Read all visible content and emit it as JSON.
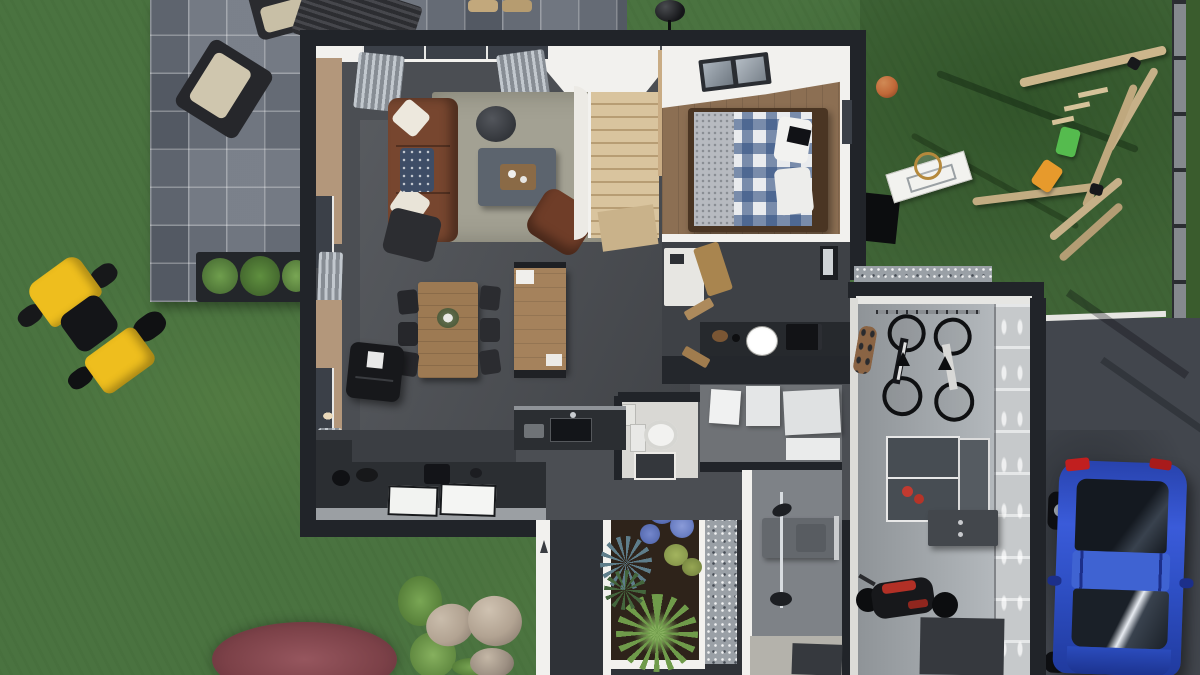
{
  "scene": {
    "title": "Top-down 3D rendering of a modern single-storey house floor plan with garden",
    "house": {
      "rooms": [
        {
          "name": "living-room",
          "furniture": [
            "brown-sofa",
            "white-pillows",
            "coffee-table",
            "brown-armchair",
            "dark-chair",
            "rug",
            "gray-curtains",
            "windows"
          ]
        },
        {
          "name": "dining-room",
          "furniture": [
            "wooden-dining-table",
            "dark-chairs",
            "wooden-island-table",
            "black-wood-stove",
            "world-map-wall-decal"
          ]
        },
        {
          "name": "kitchen",
          "furniture": [
            "dark-counters",
            "double-white-sink",
            "kitchen-island-with-sink",
            "small-appliances"
          ]
        },
        {
          "name": "staircase",
          "furniture": [
            "winding-wood-stairs",
            "wood-plank-wall"
          ]
        },
        {
          "name": "bedroom",
          "furniture": [
            "double-bed-plaid-duvet",
            "gray-blanket",
            "white-pillows",
            "roof-skylight-window"
          ]
        },
        {
          "name": "utility-room",
          "furniture": [
            "white-counter",
            "wall-clock",
            "microwave",
            "picture-frame",
            "shelf-items"
          ]
        },
        {
          "name": "wc",
          "furniture": [
            "toilet",
            "small-sink",
            "dark-mat"
          ]
        },
        {
          "name": "storage-room",
          "furniture": [
            "white-storage-boxes"
          ]
        },
        {
          "name": "bathroom",
          "furniture": [
            "shower-column",
            "gray-vanity",
            "towel-bar",
            "dark-mat"
          ]
        },
        {
          "name": "entry-courtyard",
          "furniture": [
            "garden-bed-with-plants",
            "gravel-path",
            "white-border-walls"
          ]
        },
        {
          "name": "garage",
          "furniture": [
            "two-wall-mounted-bicycles",
            "skateboard",
            "ping-pong-table-folded-half",
            "red-paddles",
            "wall-cabinet",
            "motorcycle",
            "floor-mat"
          ]
        }
      ]
    },
    "outdoor": {
      "patio": [
        "stone-tile-terrace",
        "dark-armchairs-beige-cushions",
        "slatted-table",
        "two-stools",
        "planter-with-shrubs"
      ],
      "yard_left": [
        "yellow-riding-mower",
        "red-bush",
        "green-shrubs",
        "three-rocks"
      ],
      "yard_top_right": [
        "wooden-swing-set",
        "green-swing-seat",
        "orange-swing-seat",
        "basketball",
        "basketball-hoop-backboard",
        "black-panel",
        "kettle-grill",
        "gray-fence"
      ],
      "driveway": [
        "dark-asphalt",
        "white-curb",
        "blue-suv-car"
      ],
      "garden_bed_plants": [
        "large-palm",
        "blue-hydrangeas",
        "spiky-yucca",
        "ferns",
        "round-bushes"
      ]
    },
    "vehicles": [
      {
        "name": "blue-suv",
        "color_key": "carBlue",
        "location": "driveway"
      },
      {
        "name": "riding-mower",
        "color_key": "mowerYellow",
        "location": "lawn-left"
      },
      {
        "name": "motorcycle",
        "color_key": "motoRed",
        "location": "garage"
      }
    ]
  },
  "colors": {
    "grass": "#4a7340",
    "grassDark": "#3a5c2d",
    "patioTile": "#747a84",
    "houseWall": "#212429",
    "interiorFloor": "#4b4e53",
    "kitchenFloor": "#3b3e43",
    "ceilWhite": "#f2f1ee",
    "tanWall": "#b3977b",
    "woodFloor": "#8c6f53",
    "stairWood": "#cdb794",
    "rug": "#a3a193",
    "sofaBrown": "#77462f",
    "armchairBrown": "#6f3d28",
    "tableWood": "#9d7a53",
    "counterDark": "#2b2e32",
    "sinkWhite": "#f2f3f1",
    "plaidBlue": "#345282",
    "bedFrame": "#4a3523",
    "garageFloor": "#a2a7ab",
    "garagePanel": "#c6c9cb",
    "gravel": "#9aa0a6",
    "driveway": "#42464d",
    "carBlue": "#2e4fc4",
    "mowerYellow": "#eebe1e",
    "swingWood": "#ccb68c",
    "seatGreen": "#55bb4e",
    "seatOrange": "#e79a2c",
    "ballOrange": "#c06838",
    "fenceGray": "#85898e",
    "soil": "#2e231a",
    "plantGreen": "#4e7d3a",
    "hydrangeaBlue": "#5a6fb5",
    "rockBeige": "#b2a392",
    "bushRed": "#7c4148",
    "pingpongTable": "#474d53",
    "motoRed": "#b23026",
    "bathFloor": "#7e8287"
  }
}
